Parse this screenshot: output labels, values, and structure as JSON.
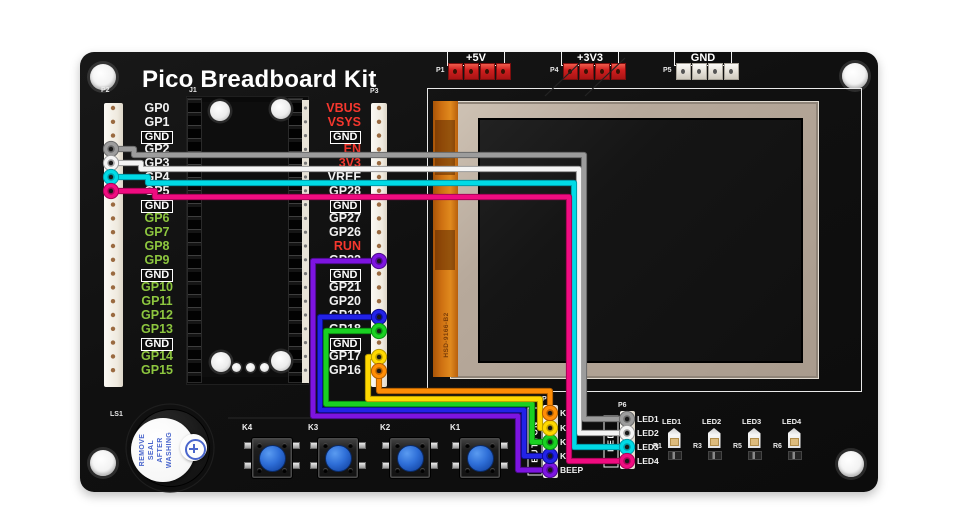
{
  "title": "Pico Breadboard Kit",
  "power_headers": [
    {
      "id": "P1",
      "label": "+5V",
      "pin_style": "red"
    },
    {
      "id": "P4",
      "label": "+3V3",
      "pin_style": "red"
    },
    {
      "id": "P5",
      "label": "GND",
      "pin_style": "silver"
    }
  ],
  "headers": {
    "p2": {
      "id": "P2",
      "pins": [
        {
          "label": "GP0",
          "kind": "white"
        },
        {
          "label": "GP1",
          "kind": "white"
        },
        {
          "label": "GND",
          "kind": "gnd"
        },
        {
          "label": "GP2",
          "kind": "white"
        },
        {
          "label": "GP3",
          "kind": "white"
        },
        {
          "label": "GP4",
          "kind": "white"
        },
        {
          "label": "GP5",
          "kind": "white"
        },
        {
          "label": "GND",
          "kind": "gnd"
        },
        {
          "label": "GP6",
          "kind": "green"
        },
        {
          "label": "GP7",
          "kind": "green"
        },
        {
          "label": "GP8",
          "kind": "green"
        },
        {
          "label": "GP9",
          "kind": "green"
        },
        {
          "label": "GND",
          "kind": "gnd"
        },
        {
          "label": "GP10",
          "kind": "green"
        },
        {
          "label": "GP11",
          "kind": "green"
        },
        {
          "label": "GP12",
          "kind": "green"
        },
        {
          "label": "GP13",
          "kind": "green"
        },
        {
          "label": "GND",
          "kind": "gnd"
        },
        {
          "label": "GP14",
          "kind": "green"
        },
        {
          "label": "GP15",
          "kind": "green"
        }
      ]
    },
    "j1": {
      "id": "J1"
    },
    "p3": {
      "id": "P3",
      "pins": [
        {
          "label": "VBUS",
          "kind": "red"
        },
        {
          "label": "VSYS",
          "kind": "red"
        },
        {
          "label": "GND",
          "kind": "gnd"
        },
        {
          "label": "EN",
          "kind": "red"
        },
        {
          "label": "3V3",
          "kind": "red"
        },
        {
          "label": "VREF",
          "kind": "white"
        },
        {
          "label": "GP28",
          "kind": "white"
        },
        {
          "label": "GND",
          "kind": "gnd"
        },
        {
          "label": "GP27",
          "kind": "white"
        },
        {
          "label": "GP26",
          "kind": "white"
        },
        {
          "label": "RUN",
          "kind": "red"
        },
        {
          "label": "GP22",
          "kind": "white"
        },
        {
          "label": "GND",
          "kind": "gnd"
        },
        {
          "label": "GP21",
          "kind": "white"
        },
        {
          "label": "GP20",
          "kind": "white"
        },
        {
          "label": "GP19",
          "kind": "white"
        },
        {
          "label": "GP18",
          "kind": "white"
        },
        {
          "label": "GND",
          "kind": "gnd"
        },
        {
          "label": "GP17",
          "kind": "white"
        },
        {
          "label": "GP16",
          "kind": "white"
        }
      ]
    }
  },
  "lcd": {
    "flex_label": "HSD-9166-B2"
  },
  "buzzer": {
    "id": "LS1",
    "sticker_lines": [
      "REMOVE",
      "SEAL",
      "AFTER",
      "WASHING"
    ]
  },
  "buttons": [
    {
      "label": "K4"
    },
    {
      "label": "K3"
    },
    {
      "label": "K2"
    },
    {
      "label": "K1"
    }
  ],
  "button_header": {
    "id": "P7",
    "box_label": "BUTTON",
    "pins": [
      {
        "label": "K1"
      },
      {
        "label": "K2"
      },
      {
        "label": "K3"
      },
      {
        "label": "K4"
      },
      {
        "label": "BEEP"
      }
    ]
  },
  "led_header": {
    "id": "P6",
    "box_label": "LED",
    "pins": [
      {
        "label": "LED1"
      },
      {
        "label": "LED2"
      },
      {
        "label": "LED3"
      },
      {
        "label": "LED4"
      }
    ]
  },
  "leds": [
    {
      "label": "LED1",
      "resistor": "R1"
    },
    {
      "label": "LED2",
      "resistor": "R3"
    },
    {
      "label": "LED3",
      "resistor": "R5"
    },
    {
      "label": "LED4",
      "resistor": "R6"
    }
  ],
  "colors": {
    "gpio_text": "#f2f2f2",
    "gpio_alt_text": "#8dc63f",
    "power_text": "#f5372e",
    "board_black": "#101010",
    "sticker_blue": "#4a66cc",
    "button_cap_blue": "#2f6fd8"
  },
  "wires": [
    {
      "id": "wire-gp2-led1",
      "from": "P2 GP2",
      "to": "P6 LED1",
      "color": "#9c9c9c",
      "edge": "#6a6a6a",
      "points": [
        [
          111,
          149
        ],
        [
          134,
          149
        ],
        [
          134,
          155
        ],
        [
          584,
          155
        ],
        [
          584,
          419
        ],
        [
          627,
          419
        ]
      ]
    },
    {
      "id": "wire-gp3-led2",
      "from": "P2 GP3",
      "to": "P6 LED2",
      "color": "#f4f4f4",
      "edge": "#9a9a9a",
      "points": [
        [
          111,
          163
        ],
        [
          141,
          163
        ],
        [
          141,
          169
        ],
        [
          579,
          169
        ],
        [
          579,
          433
        ],
        [
          627,
          433
        ]
      ]
    },
    {
      "id": "wire-gp4-led3",
      "from": "P2 GP4",
      "to": "P6 LED3",
      "color": "#00dbe6",
      "edge": "#009aa8",
      "points": [
        [
          111,
          177
        ],
        [
          148,
          177
        ],
        [
          148,
          183
        ],
        [
          574,
          183
        ],
        [
          574,
          447
        ],
        [
          627,
          447
        ]
      ]
    },
    {
      "id": "wire-gp5-led4",
      "from": "P2 GP5",
      "to": "P6 LED4",
      "color": "#f00c80",
      "edge": "#a80458",
      "points": [
        [
          111,
          191
        ],
        [
          155,
          191
        ],
        [
          155,
          197
        ],
        [
          569,
          197
        ],
        [
          569,
          461
        ],
        [
          627,
          461
        ]
      ]
    },
    {
      "id": "wire-gp22-beep",
      "from": "P3 GP22",
      "to": "P7 BEEP",
      "color": "#7d14e0",
      "edge": "#4d0b8c",
      "points": [
        [
          379,
          261
        ],
        [
          313,
          261
        ],
        [
          313,
          416
        ],
        [
          518,
          416
        ],
        [
          518,
          470
        ],
        [
          550,
          470
        ]
      ]
    },
    {
      "id": "wire-gp19-k4",
      "from": "P3 GP19",
      "to": "P7 K4",
      "color": "#2222e8",
      "edge": "#0d0d8f",
      "points": [
        [
          379,
          317
        ],
        [
          320,
          317
        ],
        [
          320,
          410
        ],
        [
          524,
          410
        ],
        [
          524,
          456
        ],
        [
          550,
          456
        ]
      ]
    },
    {
      "id": "wire-gp18-k3",
      "from": "P3 GP18",
      "to": "P7 K3",
      "color": "#1ad122",
      "edge": "#0a8f12",
      "points": [
        [
          379,
          331
        ],
        [
          326,
          331
        ],
        [
          326,
          404
        ],
        [
          532,
          404
        ],
        [
          532,
          442
        ],
        [
          550,
          442
        ]
      ]
    },
    {
      "id": "wire-gp17-k2",
      "from": "P3 GP17",
      "to": "P7 K2",
      "color": "#ffd800",
      "edge": "#b89a00",
      "points": [
        [
          379,
          357
        ],
        [
          368,
          357
        ],
        [
          368,
          399
        ],
        [
          540,
          399
        ],
        [
          540,
          428
        ],
        [
          550,
          428
        ]
      ]
    },
    {
      "id": "wire-gp16-k1",
      "from": "P3 GP16",
      "to": "P7 K1",
      "color": "#ff8d05",
      "edge": "#b35f00",
      "points": [
        [
          379,
          371
        ],
        [
          379,
          391
        ],
        [
          550,
          391
        ],
        [
          550,
          413
        ]
      ]
    }
  ]
}
